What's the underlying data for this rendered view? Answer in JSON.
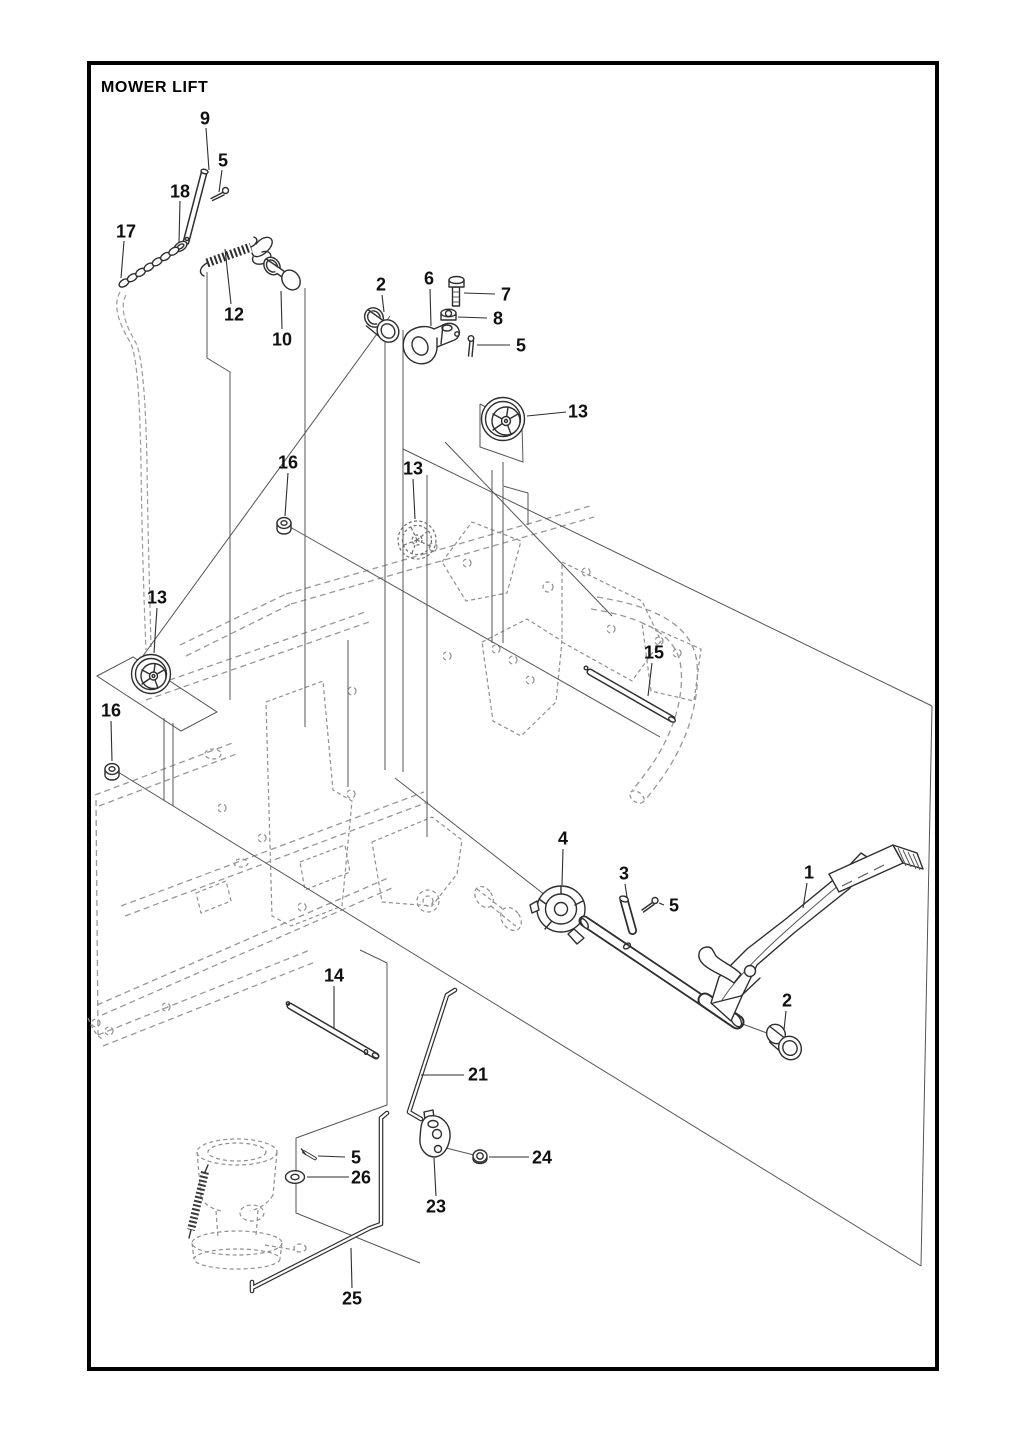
{
  "title": "MOWER LIFT",
  "colors": {
    "ink": "#2e2e2e",
    "ghost": "#989898",
    "paper": "#ffffff",
    "border": "#000000"
  },
  "callouts": [
    {
      "label": "9",
      "x": 205,
      "y": 118,
      "leader": [
        206,
        128,
        209,
        170
      ]
    },
    {
      "label": "5",
      "x": 223,
      "y": 160,
      "leader": [
        222,
        170,
        219,
        192
      ]
    },
    {
      "label": "18",
      "x": 180,
      "y": 191,
      "leader": [
        180,
        201,
        179,
        242
      ]
    },
    {
      "label": "17",
      "x": 126,
      "y": 231,
      "leader": [
        124,
        241,
        121,
        278
      ]
    },
    {
      "label": "12",
      "x": 234,
      "y": 314,
      "leader": [
        231,
        304,
        225,
        249
      ]
    },
    {
      "label": "10",
      "x": 282,
      "y": 339,
      "leader": [
        282,
        329,
        281,
        291
      ]
    },
    {
      "label": "2",
      "x": 381,
      "y": 284,
      "leader": [
        382,
        295,
        384,
        312
      ]
    },
    {
      "label": "6",
      "x": 429,
      "y": 278,
      "leader": [
        430,
        289,
        431,
        326
      ]
    },
    {
      "label": "7",
      "x": 506,
      "y": 294,
      "leader": [
        495,
        294,
        464,
        293
      ]
    },
    {
      "label": "8",
      "x": 498,
      "y": 318,
      "leader": [
        487,
        318,
        458,
        317
      ]
    },
    {
      "label": "5",
      "x": 521,
      "y": 345,
      "leader": [
        510,
        345,
        477,
        345
      ]
    },
    {
      "label": "13",
      "x": 578,
      "y": 411,
      "leader": [
        566,
        412,
        527,
        416
      ]
    },
    {
      "label": "16",
      "x": 288,
      "y": 462,
      "leader": [
        288,
        473,
        285,
        516
      ]
    },
    {
      "label": "13",
      "x": 413,
      "y": 468,
      "leader": [
        413,
        479,
        415,
        519
      ]
    },
    {
      "label": "13",
      "x": 157,
      "y": 597,
      "leader": [
        157,
        608,
        154,
        653
      ]
    },
    {
      "label": "15",
      "x": 654,
      "y": 652,
      "leader": [
        652,
        663,
        648,
        696
      ]
    },
    {
      "label": "16",
      "x": 111,
      "y": 710,
      "leader": [
        111,
        721,
        112,
        761
      ]
    },
    {
      "label": "4",
      "x": 563,
      "y": 838,
      "leader": [
        563,
        849,
        562,
        885
      ]
    },
    {
      "label": "3",
      "x": 624,
      "y": 873,
      "leader": [
        625,
        884,
        627,
        897
      ]
    },
    {
      "label": "5",
      "x": 674,
      "y": 905,
      "leader": [
        664,
        905,
        659,
        903
      ]
    },
    {
      "label": "1",
      "x": 809,
      "y": 872,
      "leader": [
        807,
        883,
        803,
        908
      ]
    },
    {
      "label": "2",
      "x": 787,
      "y": 1000,
      "leader": [
        786,
        1011,
        784,
        1030
      ]
    },
    {
      "label": "14",
      "x": 334,
      "y": 975,
      "leader": [
        334,
        986,
        334,
        1028
      ]
    },
    {
      "label": "21",
      "x": 478,
      "y": 1074,
      "leader": [
        464,
        1075,
        421,
        1075
      ]
    },
    {
      "label": "5",
      "x": 356,
      "y": 1157,
      "leader": [
        345,
        1157,
        318,
        1156
      ]
    },
    {
      "label": "26",
      "x": 361,
      "y": 1177,
      "leader": [
        349,
        1177,
        307,
        1177
      ]
    },
    {
      "label": "24",
      "x": 542,
      "y": 1157,
      "leader": [
        529,
        1157,
        489,
        1157
      ]
    },
    {
      "label": "23",
      "x": 436,
      "y": 1206,
      "leader": [
        436,
        1196,
        434,
        1158
      ]
    },
    {
      "label": "25",
      "x": 352,
      "y": 1298,
      "leader": [
        352,
        1288,
        351,
        1248
      ]
    }
  ]
}
